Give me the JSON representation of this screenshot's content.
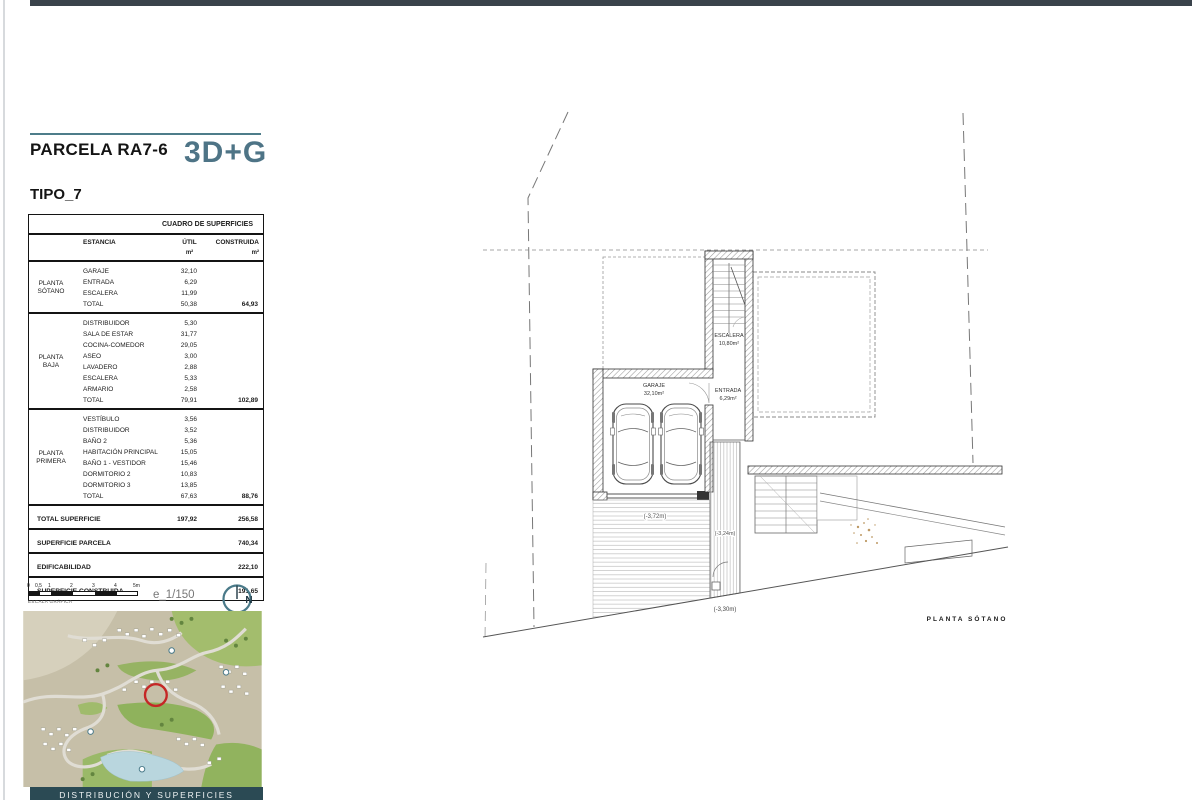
{
  "header": {
    "parcel": "PARCELA RA7-6",
    "logo": "3D+G",
    "type": "TIPO_7"
  },
  "surfaces_table": {
    "title": "CUADRO DE SUPERFICIES",
    "columns": {
      "estancia": "ESTANCIA",
      "util": "ÚTIL",
      "construida": "CONSTRUIDA",
      "unit": "m²"
    },
    "sections": [
      {
        "floor": "PLANTA SÓTANO",
        "rows": [
          {
            "name": "GARAJE",
            "util": "32,10",
            "constr": ""
          },
          {
            "name": "ENTRADA",
            "util": "6,29",
            "constr": ""
          },
          {
            "name": "ESCALERA",
            "util": "11,99",
            "constr": ""
          },
          {
            "name": "TOTAL",
            "util": "50,38",
            "constr": "64,93"
          }
        ]
      },
      {
        "floor": "PLANTA BAJA",
        "rows": [
          {
            "name": "DISTRIBUIDOR",
            "util": "5,30",
            "constr": ""
          },
          {
            "name": "SALA DE ESTAR",
            "util": "31,77",
            "constr": ""
          },
          {
            "name": "COCINA-COMEDOR",
            "util": "29,05",
            "constr": ""
          },
          {
            "name": "ASEO",
            "util": "3,00",
            "constr": ""
          },
          {
            "name": "LAVADERO",
            "util": "2,88",
            "constr": ""
          },
          {
            "name": "ESCALERA",
            "util": "5,33",
            "constr": ""
          },
          {
            "name": "ARMARIO",
            "util": "2,58",
            "constr": ""
          },
          {
            "name": "TOTAL",
            "util": "79,91",
            "constr": "102,89"
          }
        ]
      },
      {
        "floor": "PLANTA PRIMERA",
        "rows": [
          {
            "name": "VESTÍBULO",
            "util": "3,56",
            "constr": ""
          },
          {
            "name": "DISTRIBUIDOR",
            "util": "3,52",
            "constr": ""
          },
          {
            "name": "BAÑO 2",
            "util": "5,36",
            "constr": ""
          },
          {
            "name": "HABITACIÓN PRINCIPAL",
            "util": "15,05",
            "constr": ""
          },
          {
            "name": "BAÑO 1 - VESTIDOR",
            "util": "15,46",
            "constr": ""
          },
          {
            "name": "DORMITORIO 2",
            "util": "10,83",
            "constr": ""
          },
          {
            "name": "DORMITORIO 3",
            "util": "13,85",
            "constr": ""
          },
          {
            "name": "TOTAL",
            "util": "67,63",
            "constr": "88,76"
          }
        ]
      }
    ],
    "summary": [
      {
        "name": "TOTAL SUPERFICIE",
        "util": "197,92",
        "constr": "256,58"
      },
      {
        "name": "SUPERFICIE PARCELA",
        "util": "",
        "constr": "740,34"
      },
      {
        "name": "EDIFICABILIDAD",
        "util": "",
        "constr": "222,10"
      },
      {
        "name": "SUPERFICIE CONSTRUIDA",
        "util": "",
        "constr": "191,65"
      }
    ]
  },
  "scale": {
    "ticks": [
      "0",
      "0,5",
      "1",
      "2",
      "3",
      "4",
      "5m"
    ],
    "caption": "ESCALA GRÁFICA",
    "ratio": "e_1/150",
    "north": "N"
  },
  "plan": {
    "labels": {
      "escalera_name": "ESCALERA",
      "escalera_area": "10,80m²",
      "garaje_name": "GARAJE",
      "garaje_area": "32,10m²",
      "entrada_name": "ENTRADA",
      "entrada_area": "6,29m²",
      "level_driveway": "(-3,72m)",
      "level_entry": "(-3,24m)",
      "level_street": "(-3,30m)",
      "caption": "PLANTA SÓTANO"
    }
  },
  "footer": {
    "label": "DISTRIBUCIÓN Y SUPERFICIES"
  },
  "colors": {
    "accent_teal": "#4e7d8a",
    "logo_teal": "#4e7486",
    "top_bar": "#3a434b",
    "footer_bar": "#2b4a54",
    "marker_red": "#c52726"
  }
}
